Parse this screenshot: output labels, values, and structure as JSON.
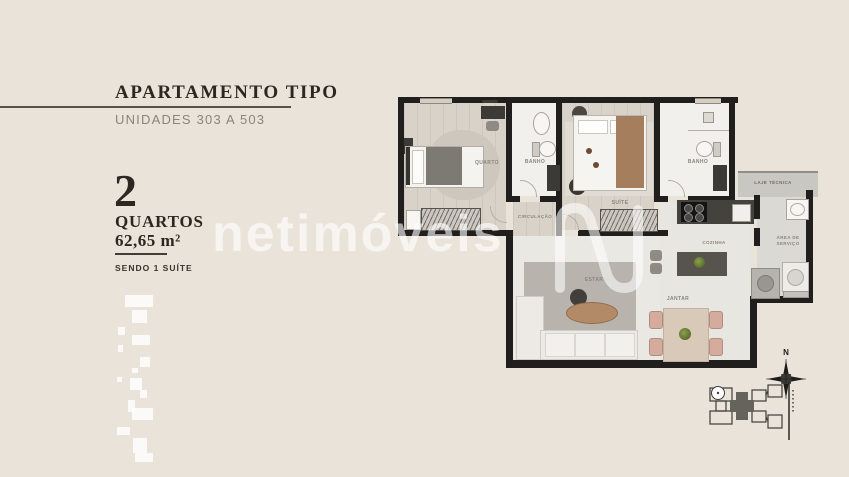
{
  "panel": {
    "title": "APARTAMENTO TIPO",
    "subtitle": "UNIDADES 303 A 503",
    "quantity": "2",
    "quantity_label": "QUARTOS",
    "area": "62,65 m²",
    "note": "SENDO 1 SUÍTE"
  },
  "watermark": {
    "brand": "netimóveis"
  },
  "floorplan": {
    "labels": {
      "quarto": "QUARTO",
      "banho_1": "BANHO",
      "circulacao": "CIRCULAÇÃO",
      "suite": "SUÍTE",
      "banho_2": "BANHO",
      "cozinha": "COZINHA",
      "estar": "ESTAR",
      "jantar": "JANTAR",
      "laje_tecnica": "LAJE TÉCNICA",
      "area_servico": "ÁREA DE SERVIÇO"
    },
    "compass_north": "N"
  },
  "colors": {
    "background": "#e9e3da",
    "wall": "#201f1d",
    "floor_wood": "#d8d2c9",
    "floor_light": "#f1f0ed",
    "accent_wood": "#a57e5e",
    "plant_green": "#6c7c3c",
    "dining_chair": "#d4ab9c",
    "watermark_white": "#ffffff"
  }
}
